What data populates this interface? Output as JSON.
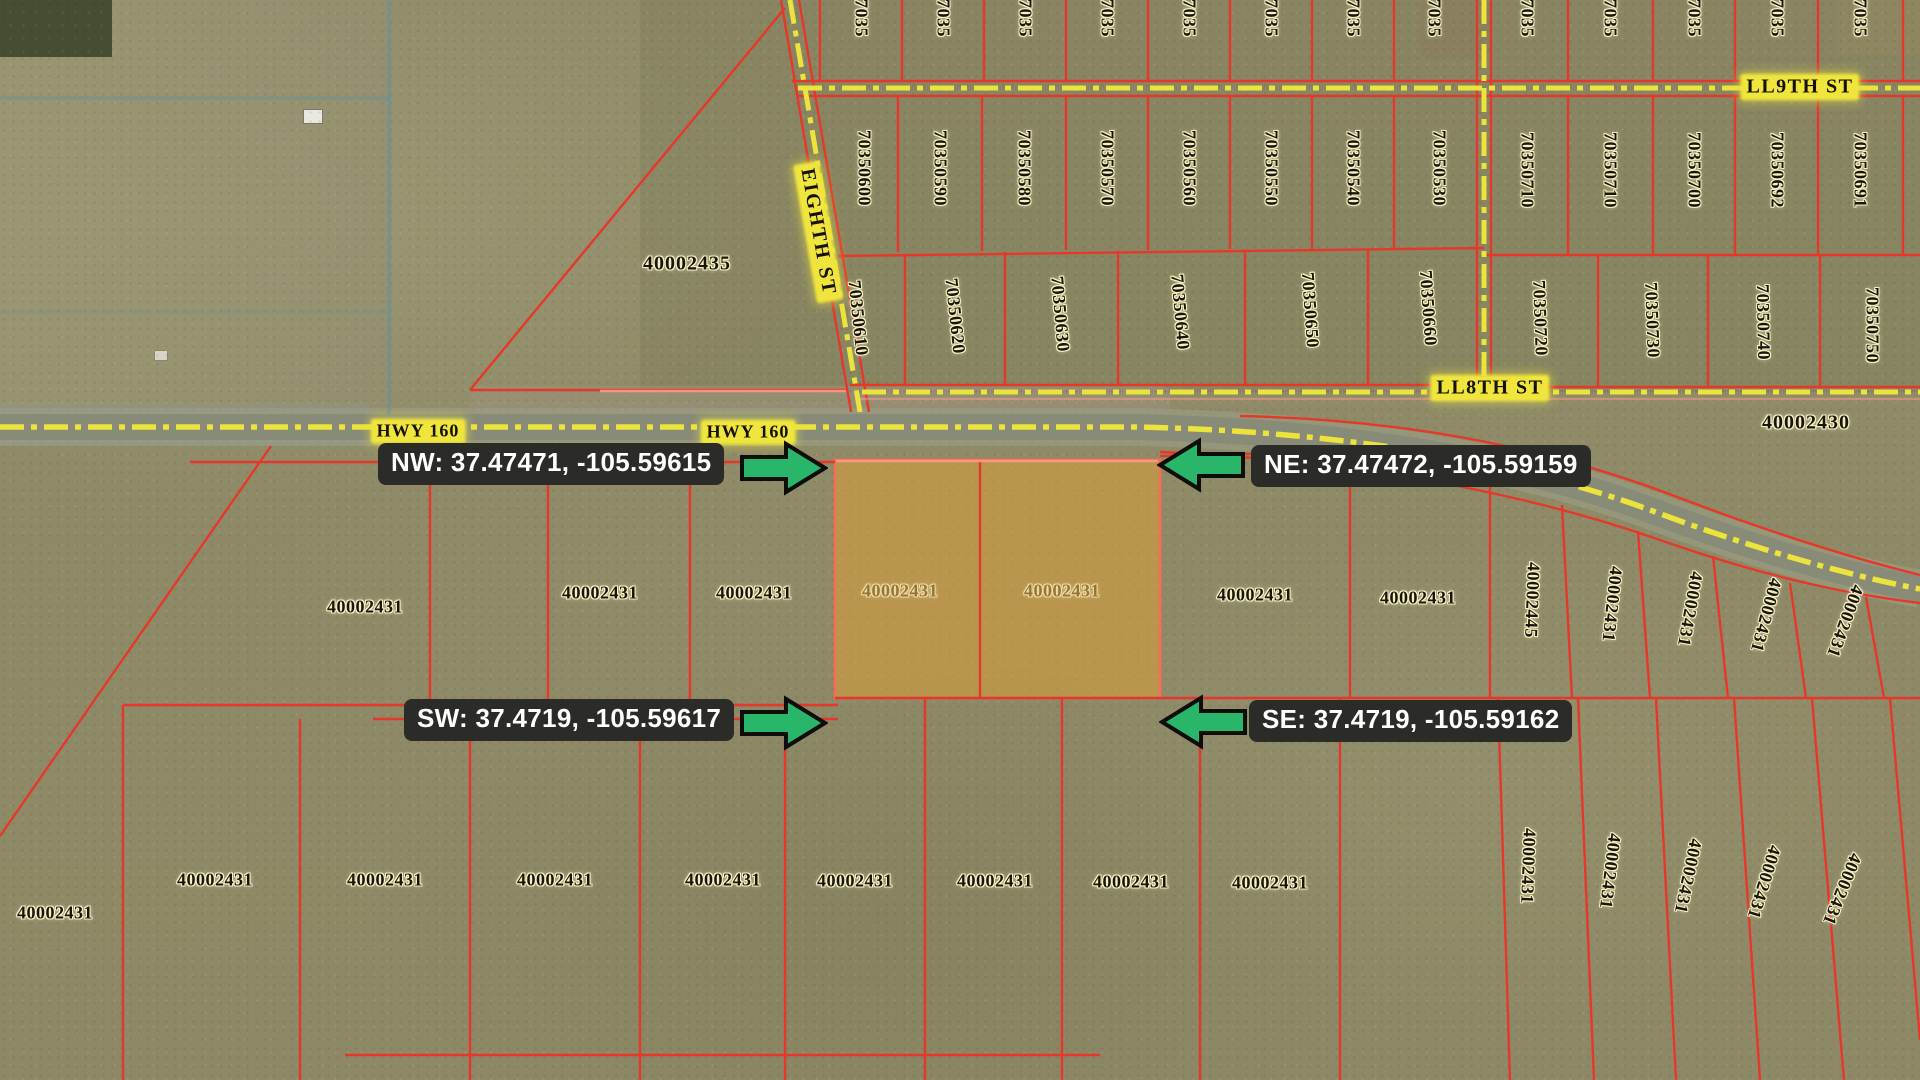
{
  "map": {
    "colors": {
      "highlight_parcel": "#DD9E38",
      "parcel_line": "#E6382A",
      "street_dash": "#ECE33C",
      "callout_bg": "#2B2B27",
      "callout_text": "#FFFFFF",
      "arrow_green": "#29B56A"
    },
    "streets": {
      "hwy160_labels": [
        "HWY 160",
        "HWY 160"
      ],
      "eighth": "EIGHTH ST",
      "ll9th": "LL9TH ST",
      "ll8th": "LL8TH ST"
    },
    "highlighted_parcel_id": "40002431",
    "callouts": [
      {
        "id": "nw",
        "text": "NW: 37.47471, -105.59615",
        "box_x": 378,
        "box_y": 443,
        "dir": "right",
        "ax": 740,
        "ay": 440
      },
      {
        "id": "ne",
        "text": "NE: 37.47472, -105.59159",
        "box_x": 1251,
        "box_y": 445,
        "dir": "left",
        "ax": 1157,
        "ay": 437
      },
      {
        "id": "sw",
        "text": "SW: 37.4719, -105.59617",
        "box_x": 404,
        "box_y": 699,
        "dir": "right",
        "ax": 740,
        "ay": 695
      },
      {
        "id": "se",
        "text": "SE: 37.4719, -105.59162",
        "box_x": 1249,
        "box_y": 700,
        "dir": "left",
        "ax": 1159,
        "ay": 694
      }
    ],
    "parcel_labels": [
      {
        "t": "7035",
        "x": 861,
        "y": 18,
        "r": 90
      },
      {
        "t": "7035",
        "x": 943,
        "y": 18,
        "r": 90
      },
      {
        "t": "7035",
        "x": 1025,
        "y": 18,
        "r": 90
      },
      {
        "t": "7035",
        "x": 1107,
        "y": 18,
        "r": 90
      },
      {
        "t": "7035",
        "x": 1189,
        "y": 18,
        "r": 90
      },
      {
        "t": "7035",
        "x": 1271,
        "y": 18,
        "r": 90
      },
      {
        "t": "7035",
        "x": 1353,
        "y": 18,
        "r": 90
      },
      {
        "t": "7035",
        "x": 1434,
        "y": 18,
        "r": 90
      },
      {
        "t": "7035",
        "x": 1527,
        "y": 18,
        "r": 90
      },
      {
        "t": "7035",
        "x": 1610,
        "y": 18,
        "r": 90
      },
      {
        "t": "7035",
        "x": 1694,
        "y": 18,
        "r": 90
      },
      {
        "t": "7035",
        "x": 1777,
        "y": 18,
        "r": 90
      },
      {
        "t": "7035",
        "x": 1860,
        "y": 18,
        "r": 90
      },
      {
        "t": "70350600",
        "x": 864,
        "y": 168,
        "r": 90
      },
      {
        "t": "70350590",
        "x": 940,
        "y": 168,
        "r": 90
      },
      {
        "t": "70350580",
        "x": 1024,
        "y": 168,
        "r": 90
      },
      {
        "t": "70350570",
        "x": 1107,
        "y": 168,
        "r": 90
      },
      {
        "t": "70350560",
        "x": 1189,
        "y": 168,
        "r": 90
      },
      {
        "t": "70350550",
        "x": 1271,
        "y": 168,
        "r": 90
      },
      {
        "t": "70350540",
        "x": 1353,
        "y": 168,
        "r": 90
      },
      {
        "t": "70350530",
        "x": 1439,
        "y": 168,
        "r": 90
      },
      {
        "t": "70350710",
        "x": 1527,
        "y": 170,
        "r": 90
      },
      {
        "t": "70350710",
        "x": 1610,
        "y": 170,
        "r": 90
      },
      {
        "t": "70350700",
        "x": 1694,
        "y": 170,
        "r": 90
      },
      {
        "t": "70350692",
        "x": 1777,
        "y": 170,
        "r": 90
      },
      {
        "t": "70350691",
        "x": 1860,
        "y": 170,
        "r": 90
      },
      {
        "t": "70350610",
        "x": 858,
        "y": 318,
        "r": 84
      },
      {
        "t": "70350620",
        "x": 955,
        "y": 316,
        "r": 84
      },
      {
        "t": "70350630",
        "x": 1060,
        "y": 314,
        "r": 85
      },
      {
        "t": "70350640",
        "x": 1180,
        "y": 312,
        "r": 85
      },
      {
        "t": "70350650",
        "x": 1310,
        "y": 310,
        "r": 86
      },
      {
        "t": "70350660",
        "x": 1428,
        "y": 308,
        "r": 86
      },
      {
        "t": "70350720",
        "x": 1540,
        "y": 318,
        "r": 88
      },
      {
        "t": "70350730",
        "x": 1652,
        "y": 320,
        "r": 88
      },
      {
        "t": "70350740",
        "x": 1763,
        "y": 322,
        "r": 89
      },
      {
        "t": "70350750",
        "x": 1872,
        "y": 325,
        "r": 90
      },
      {
        "t": "40002435",
        "x": 687,
        "y": 264,
        "r": 0,
        "c": "area"
      },
      {
        "t": "40002430",
        "x": 1806,
        "y": 423,
        "r": 0,
        "c": "area"
      },
      {
        "t": "40002431",
        "x": 365,
        "y": 607,
        "r": 0
      },
      {
        "t": "40002431",
        "x": 600,
        "y": 593,
        "r": 0
      },
      {
        "t": "40002431",
        "x": 754,
        "y": 593,
        "r": 0
      },
      {
        "t": "40002431",
        "x": 900,
        "y": 591,
        "r": 0,
        "c": "tint"
      },
      {
        "t": "40002431",
        "x": 1062,
        "y": 591,
        "r": 0,
        "c": "tint"
      },
      {
        "t": "40002431",
        "x": 1255,
        "y": 595,
        "r": 0
      },
      {
        "t": "40002431",
        "x": 1418,
        "y": 598,
        "r": 0
      },
      {
        "t": "40002445",
        "x": 1532,
        "y": 600,
        "r": 92
      },
      {
        "t": "40002431",
        "x": 1612,
        "y": 604,
        "r": 96
      },
      {
        "t": "40002431",
        "x": 1690,
        "y": 609,
        "r": 100
      },
      {
        "t": "40002431",
        "x": 1766,
        "y": 615,
        "r": 105
      },
      {
        "t": "40002431",
        "x": 1845,
        "y": 621,
        "r": 110
      },
      {
        "t": "40002431",
        "x": 215,
        "y": 880,
        "r": 0
      },
      {
        "t": "40002431",
        "x": 385,
        "y": 880,
        "r": 0
      },
      {
        "t": "40002431",
        "x": 555,
        "y": 880,
        "r": 0
      },
      {
        "t": "40002431",
        "x": 723,
        "y": 880,
        "r": 0
      },
      {
        "t": "40002431",
        "x": 855,
        "y": 881,
        "r": 0
      },
      {
        "t": "40002431",
        "x": 995,
        "y": 881,
        "r": 0
      },
      {
        "t": "40002431",
        "x": 1131,
        "y": 882,
        "r": 0
      },
      {
        "t": "40002431",
        "x": 1270,
        "y": 883,
        "r": 0
      },
      {
        "t": "40002431",
        "x": 55,
        "y": 913,
        "r": 0
      },
      {
        "t": "40002431",
        "x": 1528,
        "y": 866,
        "r": 92
      },
      {
        "t": "40002431",
        "x": 1610,
        "y": 871,
        "r": 97
      },
      {
        "t": "40002431",
        "x": 1688,
        "y": 876,
        "r": 102
      },
      {
        "t": "40002431",
        "x": 1764,
        "y": 882,
        "r": 107
      },
      {
        "t": "40002431",
        "x": 1842,
        "y": 889,
        "r": 112
      }
    ]
  }
}
